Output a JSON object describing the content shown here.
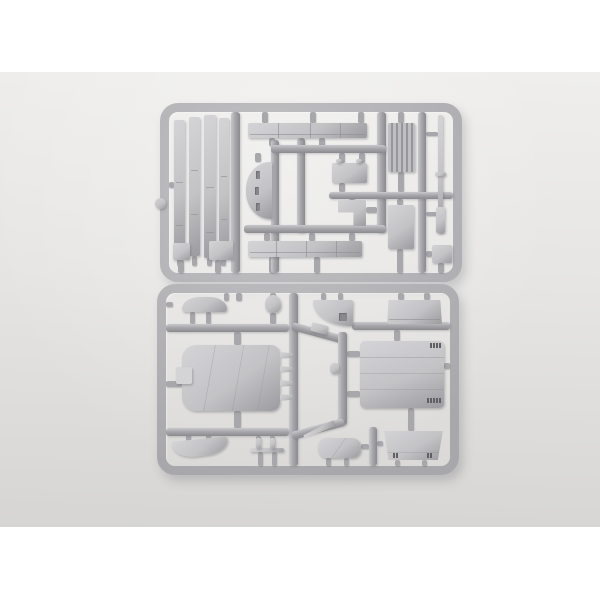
{
  "scene": {
    "type": "photograph",
    "description": "Two light-grey injection-moulded plastic model kit sprues (runner frames full of unassembled parts) photographed on a plain white surface",
    "lighting": "soft even light, subtle shadows under the frames",
    "object_count": 2
  },
  "colors": {
    "page-bg": "#ffffff",
    "photo-top": "#efeeec",
    "photo-mid": "#e6e5e3",
    "photo-bottom": "#d6d5d3",
    "runner": "#a8a8ac",
    "runner-light": "#c9c9cd",
    "runner-dark": "#8b8b8f",
    "part": "#c3c3c6",
    "part-light": "#d4d4d7",
    "part-dark": "#9c9ca0",
    "line": "#8e8e93",
    "detail": "#5f5f66",
    "slot": "#88888d"
  },
  "sprues": {
    "top": {
      "id": "sprue-a",
      "description": "Upper sprue: four long track/side-skirt strips, two long segmented beams, curved slotted mantlet piece, small hatch boxes, L-shaped bracket, ribbed engine grille, plain panel, thin gun barrel rod and small square fitting",
      "parts": [
        "track strip 1",
        "track strip 2",
        "track strip 3",
        "track strip 4",
        "segmented beam (upper)",
        "segmented beam (lower)",
        "curved slotted piece",
        "hatch box",
        "L-shaped bracket",
        "ribbed engine grille",
        "plain panel",
        "gun barrel rod",
        "small square fitting",
        "small box 1",
        "small box 2",
        "round knob"
      ]
    },
    "bottom": {
      "id": "sprue-b",
      "description": "Lower sprue: large hull tub with fins and left tab, curved front fender, curved rear fender, mushroom knob, quarter-round wedge with hatch notch, upper trapezoid plate, lined engine-deck panel with latch marks, rounded seat pad, lower trapezoid glacis plate, post rail and small diagonal stick",
      "parts": [
        "hull tub",
        "front fender",
        "rear fender",
        "mushroom knob",
        "quarter-round wedge",
        "upper trapezoid plate",
        "engine deck panel",
        "seat pad",
        "lower trapezoid plate",
        "post rail",
        "diagonal stick",
        "small wedge",
        "pin knob"
      ]
    }
  }
}
